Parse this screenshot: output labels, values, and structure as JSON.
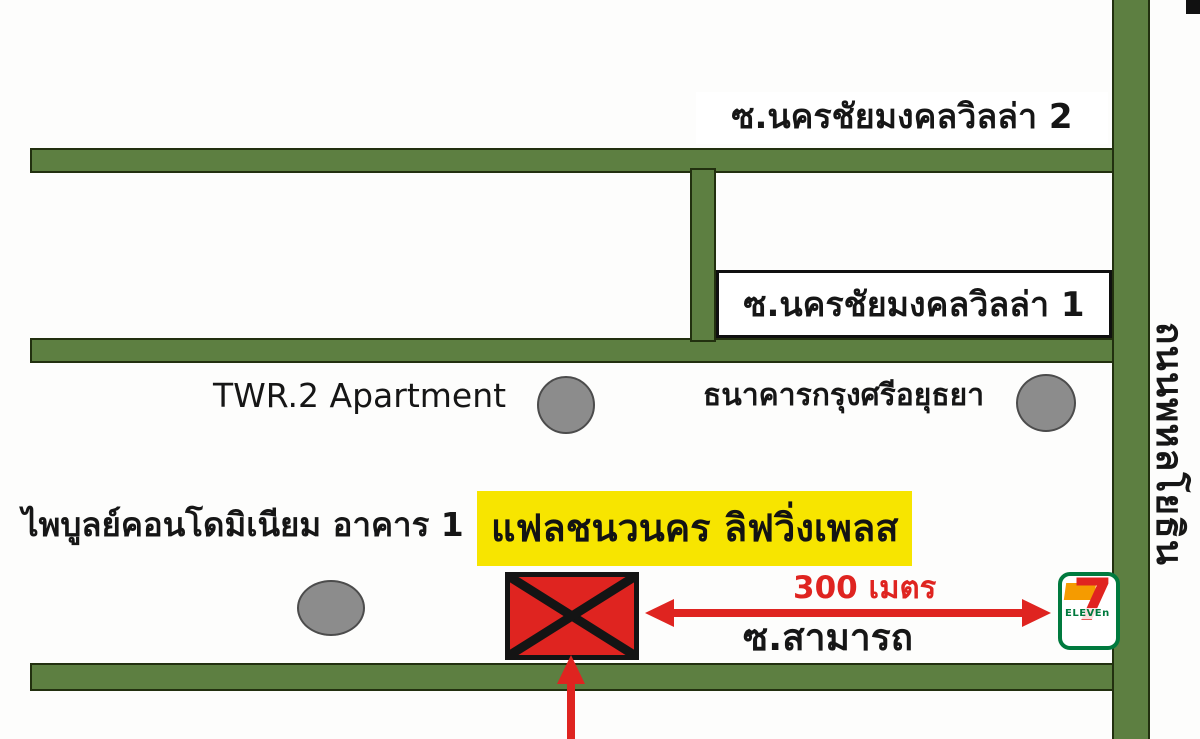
{
  "map": {
    "labels": {
      "soi_villa_2": "ซ.นครชัยมงคลวิลล่า 2",
      "soi_villa_1": "ซ.นครชัยมงคลวิลล่า 1",
      "apartment": "TWR.2 Apartment",
      "bank": "ธนาคารกรุงศรีอยุธยา",
      "condo": "ไพบูลย์คอนโดมิเนียม อาคาร 1",
      "destination": "แฟลชนวนคร ลิฟวิ่งเพลส",
      "distance": "300 เมตร",
      "soi_samart": "ซ.สามารถ",
      "main_road": "ถนนพหลโยธิน",
      "seven_eleven_digit": "7",
      "seven_eleven_word": "ELEVEn"
    },
    "colors": {
      "road_green": "#5d7f41",
      "road_outline": "#22300f",
      "highlight_yellow": "#f7e500",
      "marker_red": "#df2420",
      "circle_gray": "#8c8c8c",
      "seven_green": "#007a3e",
      "seven_orange": "#f59b00",
      "seven_red": "#e02420"
    }
  }
}
